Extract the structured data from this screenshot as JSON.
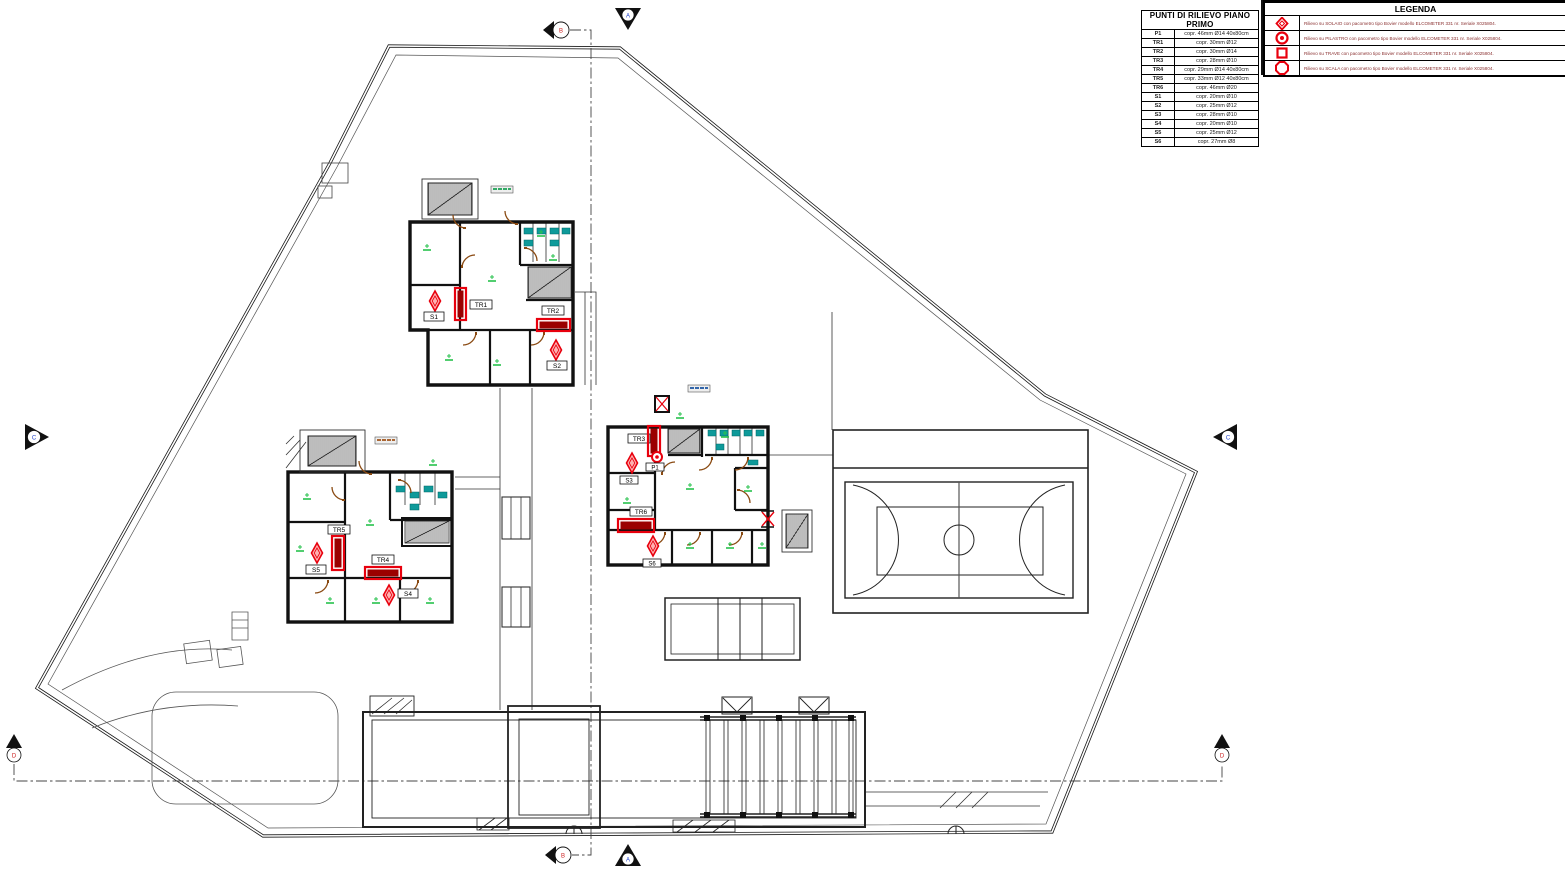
{
  "survey_table": {
    "title": "PUNTI DI RILIEVO PIANO PRIMO",
    "rows": [
      {
        "point": "P1",
        "detail": "copr. 46mm Ø14 40x80cm"
      },
      {
        "point": "TR1",
        "detail": "copr. 30mm Ø12"
      },
      {
        "point": "TR2",
        "detail": "copr. 30mm Ø14"
      },
      {
        "point": "TR3",
        "detail": "copr. 28mm Ø10"
      },
      {
        "point": "TR4",
        "detail": "copr. 29mm Ø14 40x80cm"
      },
      {
        "point": "TR5",
        "detail": "copr. 33mm Ø12 40x80cm"
      },
      {
        "point": "TR6",
        "detail": "copr. 46mm Ø20"
      },
      {
        "point": "S1",
        "detail": "copr. 20mm Ø10"
      },
      {
        "point": "S2",
        "detail": "copr. 25mm Ø12"
      },
      {
        "point": "S3",
        "detail": "copr. 28mm Ø10"
      },
      {
        "point": "S4",
        "detail": "copr. 20mm Ø10"
      },
      {
        "point": "S5",
        "detail": "copr. 25mm Ø12"
      },
      {
        "point": "S6",
        "detail": "copr. 27mm Ø8"
      }
    ]
  },
  "legend": {
    "title": "LEGENDA",
    "items": [
      {
        "symbol": "solaio-diamond-symbol",
        "text": "Rilievo su SOLAIO con pacometro tipo Bovier modello ELCOMETER 331 nr. Seriale X025804."
      },
      {
        "symbol": "pilastro-circle-symbol",
        "text": "Rilievo su PILASTRO con pacometro tipo Bovier modello ELCOMETER 331 nr. Seriale X025804."
      },
      {
        "symbol": "trave-square-symbol",
        "text": "Rilievo su TRAVE con pacometro tipo Bovier modello ELCOMETER 331 nr. Seriale X025804."
      },
      {
        "symbol": "scala-octagon-symbol",
        "text": "Rilievo su SCALA con pacometro tipo Bovier modello ELCOMETER 331 nr. Seriale X025804."
      }
    ]
  },
  "plan": {
    "survey_labels": {
      "p1": "P1",
      "tr1": "TR1",
      "tr2": "TR2",
      "tr3": "TR3",
      "tr4": "TR4",
      "tr5": "TR5",
      "tr6": "TR6",
      "s1": "S1",
      "s2": "S2",
      "s3": "S3",
      "s4": "S4",
      "s5": "S5",
      "s6": "S6"
    },
    "section_markers": {
      "a_top": "A",
      "a_bottom": "A",
      "b_top": "B",
      "b_bottom": "B",
      "c_left": "C",
      "c_right": "C",
      "d_left": "D",
      "d_right": "D"
    },
    "colors": {
      "survey_red": "#e8000d",
      "trave_fill": "#9b0000",
      "fixture_teal": "#0e9a9a",
      "room_tag_green": "#27c24c",
      "door_brown": "#8a4a12"
    }
  }
}
